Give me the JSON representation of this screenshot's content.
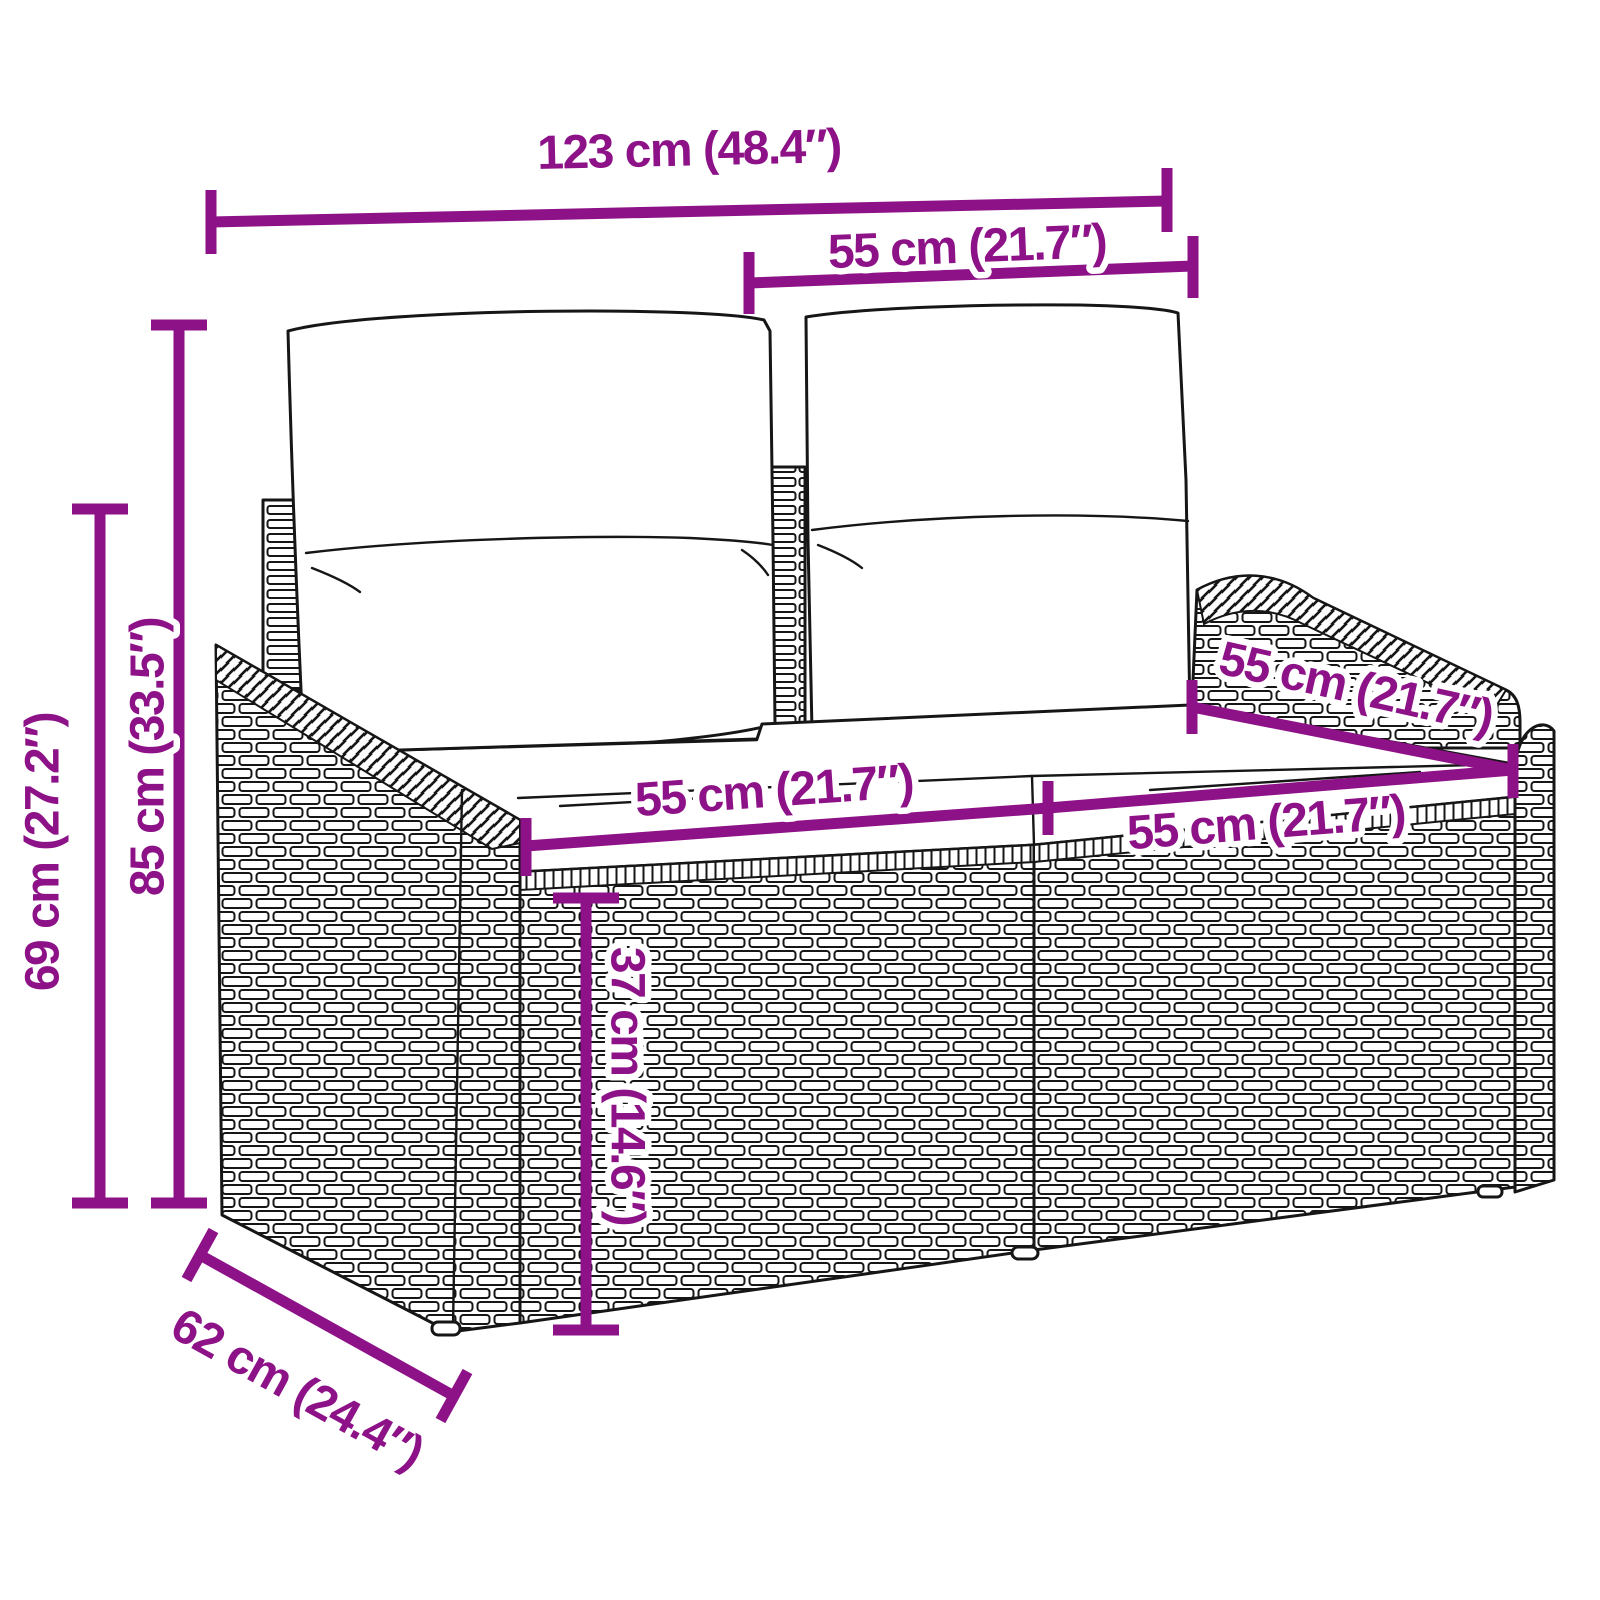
{
  "diagram": {
    "accent_color": "#8D1187",
    "ink_color": "#161616",
    "background_color": "#FFFFFF",
    "labels": {
      "overall_width": "123 cm (48.4″)",
      "backrest_section_width": "55 cm (21.7″)",
      "total_height": "85 cm (33.5″)",
      "side_height": "69 cm (27.2″)",
      "seat_left_width": "55 cm (21.7″)",
      "seat_depth": "55 cm (21.7″)",
      "seat_right_width": "55 cm (21.7″)",
      "seat_height": "37 cm (14.6″)",
      "overall_depth": "62 cm (24.4″)"
    }
  }
}
